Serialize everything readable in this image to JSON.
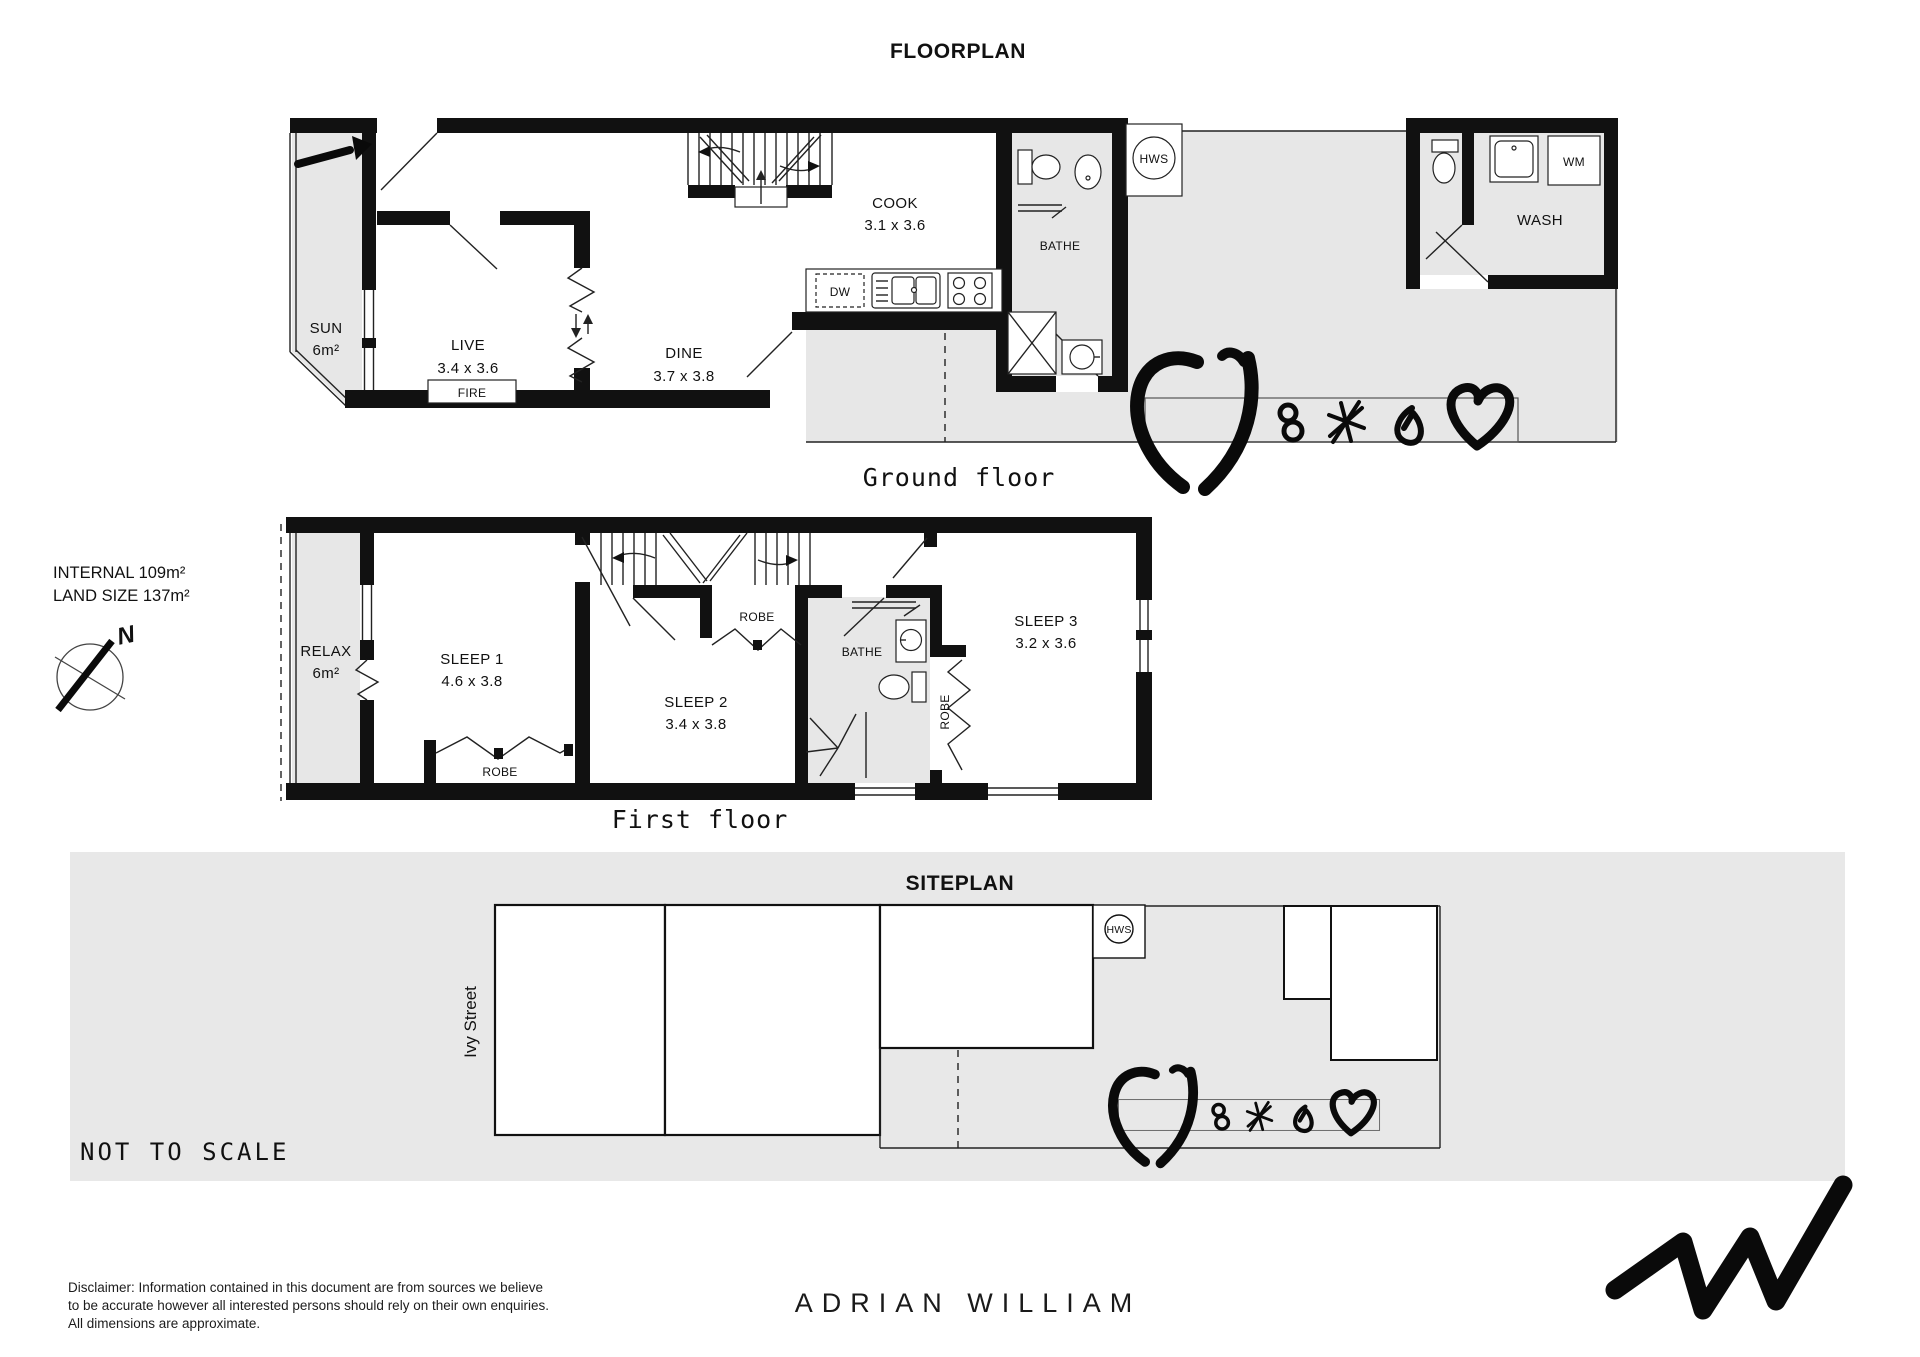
{
  "page_title": "FLOORPLAN",
  "colors": {
    "wall": "#111111",
    "area_fill": "#e7e7e7",
    "site_band": "#e8e8e8"
  },
  "ground_floor": {
    "caption": "Ground floor",
    "rooms": {
      "sun": {
        "name": "SUN",
        "area": "6m²"
      },
      "live": {
        "name": "LIVE",
        "dims": "3.4 x 3.6"
      },
      "dine": {
        "name": "DINE",
        "dims": "3.7 x 3.8"
      },
      "cook": {
        "name": "COOK",
        "dims": "3.1 x 3.6"
      },
      "bathe": {
        "name": "BATHE"
      },
      "wash": {
        "name": "WASH"
      }
    },
    "fixtures": {
      "fire": "FIRE",
      "dw": "DW",
      "wm": "WM",
      "hws": "HWS"
    }
  },
  "first_floor": {
    "caption": "First floor",
    "rooms": {
      "relax": {
        "name": "RELAX",
        "area": "6m²"
      },
      "sleep1": {
        "name": "SLEEP 1",
        "dims": "4.6 x 3.8"
      },
      "sleep2": {
        "name": "SLEEP 2",
        "dims": "3.4 x 3.8"
      },
      "sleep3": {
        "name": "SLEEP 3",
        "dims": "3.2 x 3.6"
      },
      "bathe": {
        "name": "BATHE"
      }
    },
    "fixtures": {
      "robe1": "ROBE",
      "robe2": "ROBE",
      "robe3": "ROBE"
    }
  },
  "siteplan": {
    "title": "SITEPLAN",
    "street": "Ivy Street",
    "hws": "HWS",
    "note": "NOT TO SCALE"
  },
  "summary": {
    "internal": "INTERNAL 109m²",
    "land_size": "LAND SIZE 137m²",
    "compass": "N"
  },
  "footer": {
    "disclaimer_line1": "Disclaimer: Information contained in this document are from sources we believe",
    "disclaimer_line2": "to be accurate however all interested persons should rely on their own enquiries.",
    "disclaimer_line3": "All dimensions are approximate.",
    "brand": "ADRIAN WILLIAM"
  }
}
